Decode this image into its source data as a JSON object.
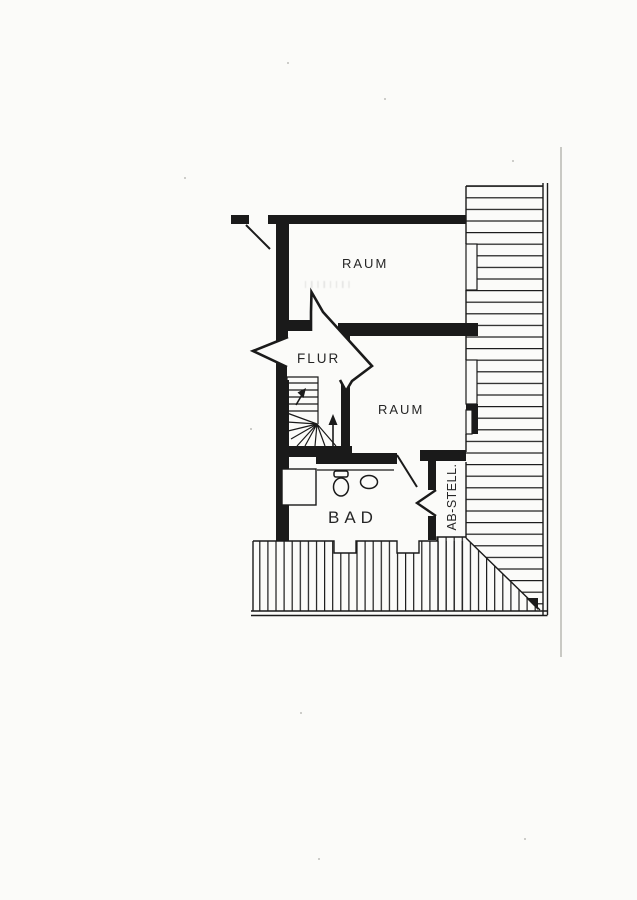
{
  "page": {
    "background_color": "#fbfbf9",
    "ink_color": "#1a1a1a",
    "faint_line_color": "#c9c9c4"
  },
  "plan": {
    "labels": {
      "room_top": "RAUM",
      "hall": "FLUR",
      "room_right": "RAUM",
      "bath": "BAD",
      "storage": "AB-STELL."
    }
  }
}
